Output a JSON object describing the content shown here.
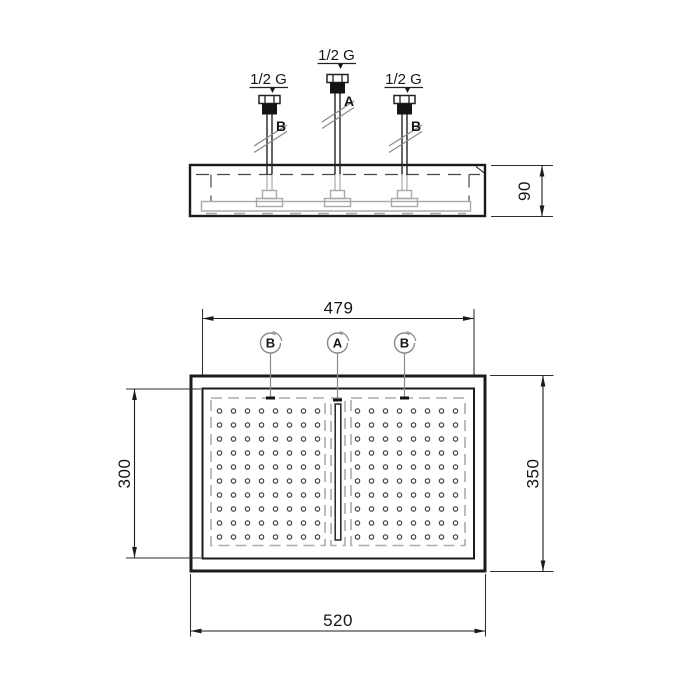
{
  "drawing": {
    "top_view": {
      "thread_label_left": "1/2 G",
      "thread_label_center": "1/2 G",
      "thread_label_right": "1/2 G",
      "pipe_letter_center": "A",
      "pipe_letter_left": "B",
      "pipe_letter_right": "B",
      "dim_body_height": "90"
    },
    "plan_view": {
      "balloon_left": "B",
      "balloon_center": "A",
      "balloon_right": "B",
      "dim_connection_span": "479",
      "dim_spray_height": "300",
      "dim_overall_height": "350",
      "dim_overall_width": "520",
      "nozzle_grid": {
        "rows": 10,
        "cols": 8,
        "fields": 2
      }
    },
    "colors": {
      "line": "#1b1b1b",
      "hidden_line": "#4a4a4a",
      "light_gray": "#a9a9a9",
      "leader_gray": "#8a8a8a",
      "background": "#ffffff"
    }
  }
}
